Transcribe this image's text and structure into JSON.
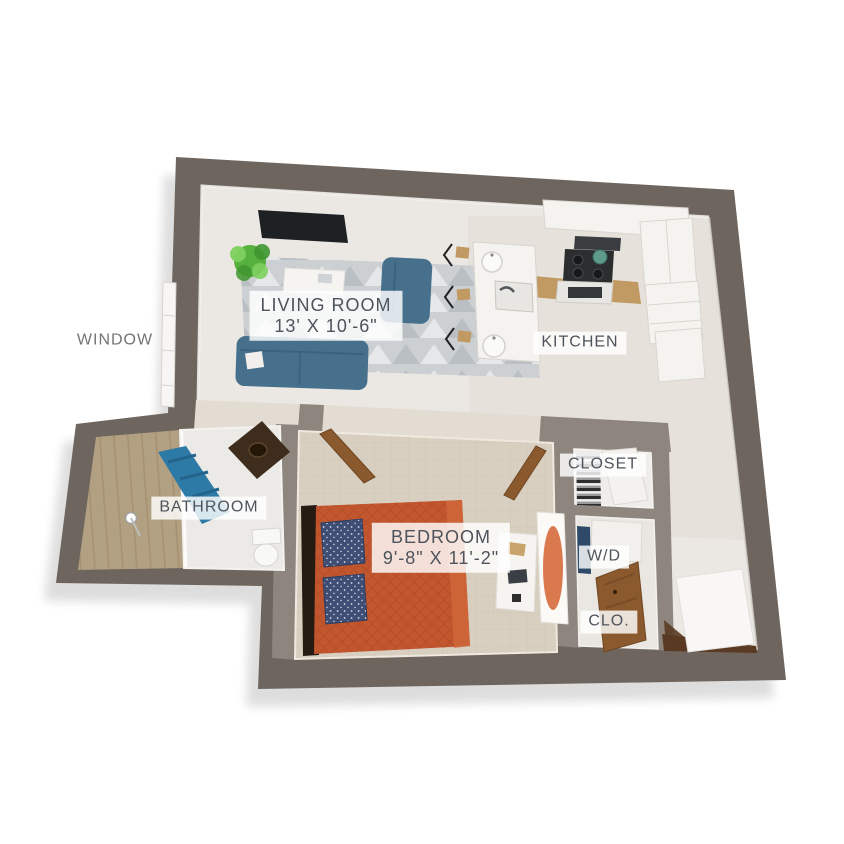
{
  "floorplan": {
    "type": "3d-apartment-floor-plan",
    "window_label": "WINDOW",
    "rooms": {
      "living_room": {
        "name": "LIVING ROOM",
        "dims": "13' X 10'-6\""
      },
      "kitchen": {
        "name": "KITCHEN"
      },
      "bathroom": {
        "name": "BATHROOM"
      },
      "bedroom": {
        "name": "BEDROOM",
        "dims": "9'-8\" X 11'-2\""
      },
      "closet": {
        "name": "CLOSET"
      },
      "washer_dryer": {
        "name": "W/D"
      },
      "closet_small": {
        "name": "CLO."
      }
    },
    "colors": {
      "wallExterior": "#6e655e",
      "wallInterior": "#8e867e",
      "wallFace": "#f1efeb",
      "floorMain": "#ebe8e3",
      "floorHall": "#e2dcd2",
      "floorKitchenTint": "#e0dacf",
      "carpet": "#d8cfc0",
      "carpetLine": "#cbc1af",
      "rugBase": "#ccd0d3",
      "rugDark": "#aeb4ba",
      "rugLight": "#e8eaec",
      "sofa": "#47708c",
      "sofaDark": "#3b5f79",
      "tableWhite": "#f6f4f1",
      "plant": "#57b13e",
      "plantLight": "#7ed05f",
      "plantDark": "#3f9630",
      "tv": "#1e2124",
      "cabinet": "#f5f3f0",
      "cabinetLine": "#d9d5cf",
      "counterWood": "#c19a63",
      "stove": "#2b2d2f",
      "potTeal": "#5f9b8a",
      "showerWood": "#b2a082",
      "showerWoodLine": "#a18c6a",
      "curtain": "#2e7aa6",
      "curtainDark": "#22648c",
      "vanity": "#3e2c1c",
      "porcelain": "#f8f8f6",
      "bed": "#c2572f",
      "bedDark": "#a7441f",
      "bedLight": "#d2693c",
      "headboard": "#261b12",
      "pillow": "#3e4e74",
      "doorWood": "#8a5a2e",
      "doorWoodDark": "#6f4623",
      "clothesDark": "#2d2d2d",
      "washerNavy": "#2e4a68",
      "entryFloor": "#5a3a22",
      "labelText": "#4e545c",
      "labelBg": "rgba(255,255,255,0.82)",
      "windowText": "#747474"
    }
  }
}
